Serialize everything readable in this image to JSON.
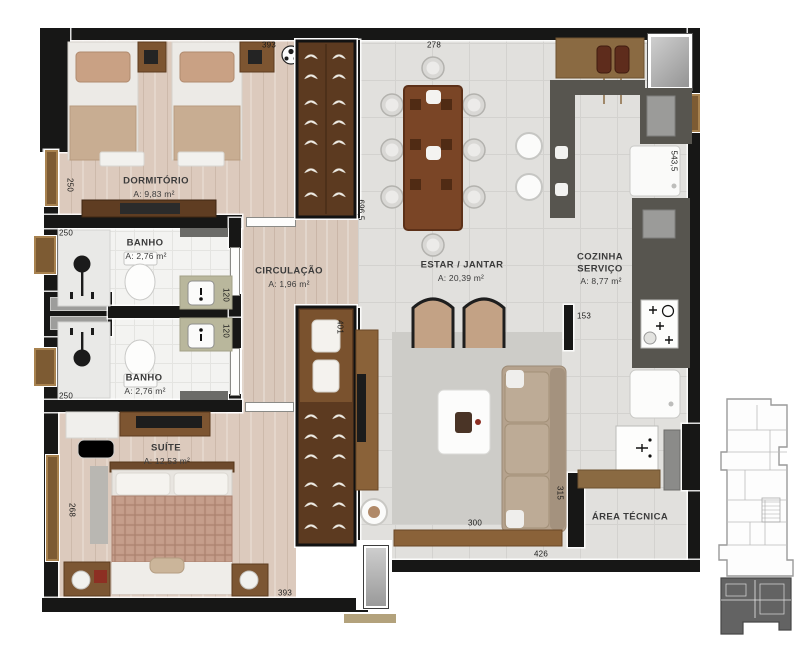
{
  "rooms": {
    "dormitorio": {
      "name": "DORMITÓRIO",
      "area": "A:  9,83 m²"
    },
    "banho1": {
      "name": "BANHO",
      "area": "A:  2,76 m²"
    },
    "circulacao": {
      "name": "CIRCULAÇÃO",
      "area": "A:  1,96 m²"
    },
    "banho2": {
      "name": "BANHO",
      "area": "A:  2,76 m²"
    },
    "suite": {
      "name": "SUÍTE",
      "area": "A:  12,53 m²"
    },
    "estar_jantar": {
      "name": "ESTAR / JANTAR",
      "area": "A:  20,39 m²"
    },
    "cozinha": {
      "name_line1": "COZINHA",
      "name_line2": "SERVIÇO",
      "area": "A:  8,77 m²"
    },
    "area_tecnica": {
      "name": "ÁREA TÉCNICA"
    }
  },
  "dimensions": {
    "top_dorm": "393",
    "top_estar": "278",
    "left_dorm": "250",
    "left_banho1": "250",
    "left_banho2": "250",
    "left_suite": "268",
    "bottom_suite": "393",
    "hall_height": "696,5",
    "closet_suite": "401",
    "banho_120_a": "120",
    "banho_120_b": "120",
    "right_kitchen": "543,5",
    "kitchen_wall": "153",
    "area_tecnica_left": "315",
    "living_bottom": "300",
    "bottom_right": "426"
  },
  "colors": {
    "wall": "#171716",
    "wood_floor": "#d9c8bb",
    "tile_floor": "#e1e0dd",
    "counter": "#56544f",
    "furniture_wood": "#7d5531",
    "window_frame": "#7d5b33",
    "keyplan_highlight": "#636363"
  }
}
